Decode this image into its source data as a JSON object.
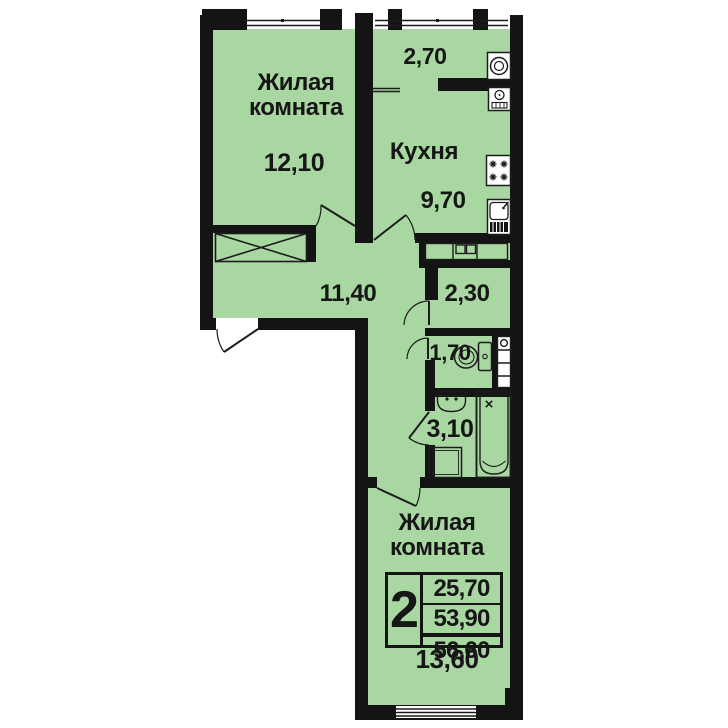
{
  "plan": {
    "type": "apartment-floor-plan",
    "rooms": {
      "living_top": {
        "label": "Жилая комната",
        "area": "12,10"
      },
      "loggia": {
        "area": "2,70"
      },
      "kitchen": {
        "label": "Кухня",
        "area": "9,70"
      },
      "hall": {
        "area": "11,40"
      },
      "inner_hall": {
        "area": "2,30"
      },
      "wc": {
        "area": "1,70"
      },
      "bathroom": {
        "area": "3,10"
      },
      "living_bottom": {
        "label": "Жилая комната",
        "area": "13,60"
      }
    },
    "summary": {
      "rooms_count": "2",
      "living_area": "25,70",
      "floor_area": "53,90",
      "total_area": "56,60"
    },
    "colors": {
      "floor_green": "#a9d7a1",
      "wall_black": "#141414",
      "line_dark": "#1c1c1c"
    },
    "icons": [
      "wardrobe-x-icon",
      "washing-machine-icon",
      "water-heater-icon",
      "stove-icon",
      "kitchen-sink-icon",
      "cabinet-row-icon",
      "toilet-icon",
      "vent-shaft-icon",
      "washbasin-icon",
      "bathtub-icon",
      "appliance-square-icon",
      "door-arc-icon",
      "window-icon"
    ]
  }
}
